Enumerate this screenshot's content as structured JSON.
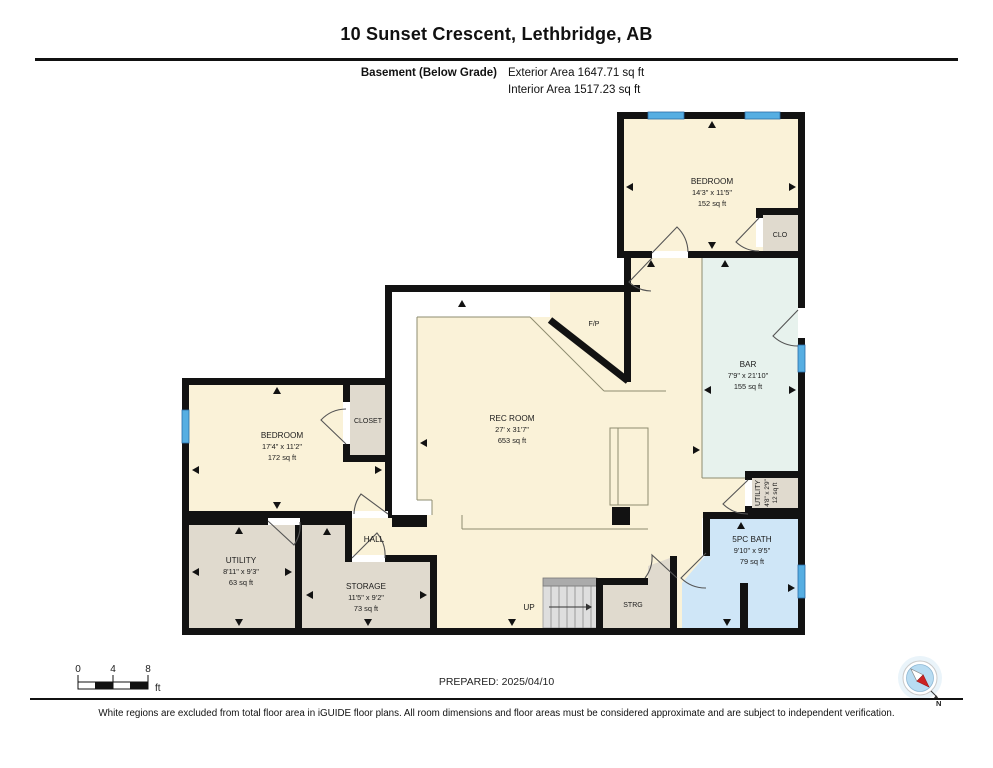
{
  "header": {
    "title": "10 Sunset Crescent, Lethbridge, AB",
    "level_label": "Basement (Below Grade)",
    "exterior_area": "Exterior Area 1647.71 sq ft",
    "interior_area": "Interior Area 1517.23 sq ft"
  },
  "rooms": {
    "bedroom2": {
      "name": "BEDROOM",
      "dims": "14'3\" x 11'5\"",
      "area": "152 sq ft"
    },
    "clo": {
      "name": "CLO"
    },
    "bar": {
      "name": "BAR",
      "dims": "7'9\" x 21'10\"",
      "area": "155 sq ft"
    },
    "fireplace": {
      "name": "F/P"
    },
    "rec": {
      "name": "REC ROOM",
      "dims": "27' x 31'7\"",
      "area": "653 sq ft"
    },
    "bedroom1": {
      "name": "BEDROOM",
      "dims": "17'4\" x 11'2\"",
      "area": "172 sq ft"
    },
    "closet": {
      "name": "CLOSET"
    },
    "utility": {
      "name": "UTILITY",
      "dims": "8'11\" x 9'3\"",
      "area": "63 sq ft"
    },
    "storage": {
      "name": "STORAGE",
      "dims": "11'5\" x 9'2\"",
      "area": "73 sq ft"
    },
    "hall": {
      "name": "HALL"
    },
    "stairs": {
      "label": "UP"
    },
    "strg": {
      "name": "STRG"
    },
    "bath": {
      "name": "5PC BATH",
      "dims": "9'10\" x 9'5\"",
      "area": "79 sq ft"
    },
    "utility2": {
      "name": "UTILITY",
      "dims": "4'8\" x 2'9\"",
      "area": "12 sq ft"
    }
  },
  "scale_bar": {
    "tick0": "0",
    "tick1": "4",
    "tick2": "8",
    "unit": "ft"
  },
  "compass": {
    "north_label": "N"
  },
  "footer": {
    "prepared": "PREPARED: 2025/04/10",
    "disclaimer": "White regions are excluded from total floor area in iGUIDE floor plans. All room dimensions and floor areas must be considered approximate and are subject to independent verification."
  },
  "colors": {
    "room_cream": "#FAF2D8",
    "room_gray": "#E0DACE",
    "room_bar": "#E7F2ED",
    "room_bath": "#CFE6F7",
    "window_blue": "#56AEE2",
    "wall": "#121212",
    "compass_red": "#CC2222"
  }
}
